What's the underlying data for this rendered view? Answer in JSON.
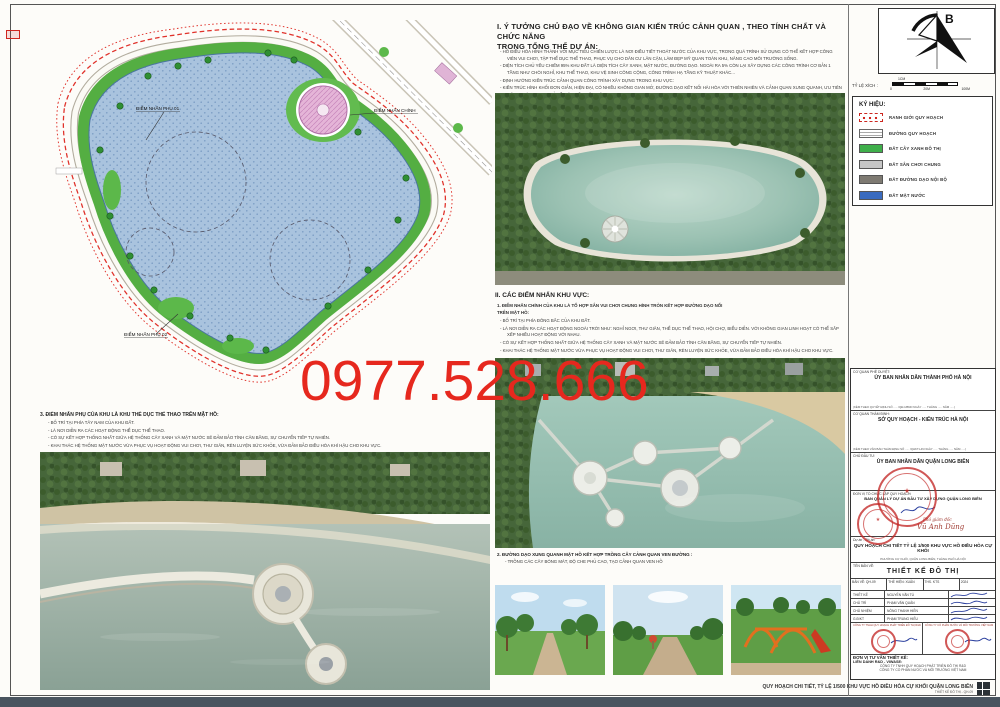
{
  "watermark": {
    "text": "0977.528.666",
    "color": "#e6281e"
  },
  "section1": {
    "heading_line1": "I. Ý TƯỞNG CHỦ ĐẠO VỀ KHÔNG GIAN KIẾN TRÚC CẢNH QUAN , THEO TÍNH CHẤT  VÀ CHỨC NĂNG",
    "heading_line2": "TRONG TỔNG THỂ DỰ ÁN:",
    "bullets": [
      "HỒ ĐIỀU HÒA HÌNH THÀNH VỚI MỤC TIÊU CHIẾN LƯỢC LÀ NƠI ĐIỀU TIẾT THOÁT NƯỚC CỦA KHU VỰC, TRONG QUÁ TRÌNH SỬ DỤNG CÓ THỂ KẾT HỢP CÔNG VIÊN VUI CHƠI, TẬP THỂ DỤC THỂ THAO, PHỤC VỤ CHO DÂN CƯ LÂN CẬN, LÀM ĐẸP MỸ QUAN TOÀN KHU, NÂNG CAO MÔI TRƯỜNG SỐNG.",
      "DIỆN TÍCH CHỦ YẾU CHIẾM 95% KHU ĐẤT LÀ DIỆN TÍCH CÂY XANH, MẶT NƯỚC, ĐƯỜNG DẠO. NGOÀI RA 5% CÒN LẠI XÂY DỰNG CÁC CÔNG TRÌNH CƠ BẢN 1 TẦNG NHƯ CHÒI NGHỈ, KHU THỂ THAO, KHU VỆ SINH CÔNG CỘNG, CÔNG TRÌNH HẠ TẦNG KỸ THUẬT KHÁC...",
      "ĐỊNH HƯỚNG KIẾN TRÚC CẢNH QUAN CÔNG TRÌNH XÂY DỰNG TRONG KHU VỰC:",
      "KIẾN TRÚC HÌNH KHỐI ĐƠN GIẢN, HIỆN ĐẠI, CÓ NHIỀU KHÔNG GIAN MỞ, ĐƯỜNG DẠO KẾT NỐI HÀI HÒA VỚI THIÊN NHIÊN VÀ CẢNH QUAN XUNG QUANH, ƯU TIÊN CÔNG TRÌNH XANH, VỎ BỀ MẶT TIẾT KIỆM NĂNG LƯỢNG.",
      "KIẾN TRÚC CÔNG TRÌNH SỬ DỤNG MÁI DỐC, KẾT HỢP MÁI BẰNG TẠO CÁC ĐƯỜNG NÉT HÀI HÒA, MỀM MẠI. SỬ DỤNG CÁC TÔNG MÀU SÁNG, TRANG NHÃ. KHAI THÁC HÌNH TƯỢNG VĂN HÓA, LỊCH SỬ TẠO NÉT ĐẶC TRƯNG, NỔI BẬT THỂ HIỆN RÕ TÍNH CHẤT CHỦ ĐẠO TRONG TỔNG THỂ.",
      "BỐ TRÍ NHIỀU CÁC MẢNG XANH, KHÔNG GIAN XANH, KHÔNG GIAN MỞ."
    ]
  },
  "section2": {
    "heading": "II. CÁC ĐIỂM NHẤN KHU VỰC:",
    "intro_line1": "1. ĐIỂM NHẤN CHÍNH CỦA KHU LÀ TỔ HỢP SÂN VUI CHƠI CHUNG HÌNH TRÒN KẾT HỢP ĐƯỜNG DẠO NỔI",
    "intro_line2": "TRÊN MẶT HỒ:",
    "bullets": [
      "BỐ TRÍ TẠI PHÍA ĐÔNG BẮC CỦA KHU ĐẤT.",
      "LÀ NƠI DIỄN RA CÁC HOẠT ĐỘNG NGOÀI TRỜI NHƯ: NGHỈ NGƠI, THƯ GIÃN, THỂ DỤC THỂ THAO, HỘI CHỢ, BIỂU DIỄN. VỚI KHÔNG GIAN LINH HOẠT CÓ THỂ SẮP XẾP NHIỀU HOẠT ĐỘNG VỚI NHAU.",
      "CÓ SỰ KẾT HỢP THỐNG NHẤT GIỮA HỆ THỐNG CÂY XANH VÀ MẶT NƯỚC SẼ ĐẢM BẢO TÍNH CÂN BẰNG, SỰ CHUYỂN TIẾP TỰ NHIÊN.",
      "KHAI THÁC HỆ THỐNG MẶT NƯỚC VỪA PHỤC VỤ HOẠT ĐỘNG VUI CHƠI, THƯ GIÃN, RÈN LUYỆN SỨC KHỎE, VỪA ĐẢM BẢO ĐIỀU HÒA KHÍ HẬU CHO KHU VỰC."
    ]
  },
  "section3_left": {
    "heading": "3. ĐIỂM NHẤN PHỤ CỦA KHU LÀ KHU THỂ DỤC THỂ THAO TRÊN MẶT HỒ:",
    "bullets": [
      "BỐ TRÍ TẠI PHÍA TÂY NAM CỦA KHU ĐẤT.",
      "LÀ NƠI DIỄN RA CÁC HOẠT ĐỘNG THỂ DỤC THỂ THAO.",
      "CÓ SỰ KẾT HỢP THỐNG NHẤT GIỮA HỆ THỐNG CÂY XANH VÀ MẶT NƯỚC SẼ ĐẢM BẢO TÍNH CÂN BẰNG, SỰ CHUYỂN TIẾP TỰ NHIÊN.",
      "KHAI THÁC HỆ THỐNG MẶT NƯỚC VỪA PHỤC VỤ HOẠT ĐỘNG VUI CHƠI, THƯ GIÃN, RÈN LUYỆN SỨC KHỎE, VỪA ĐẢM BẢO ĐIỀU HÒA KHÍ HẬU CHO KHU VỰC."
    ]
  },
  "section_photos": {
    "heading": "2. ĐƯỜNG DẠO XUNG QUANH MẶT HỒ KẾT HỢP TRỒNG CÂY CẢNH QUAN VEN ĐƯỜNG :",
    "bullet": "TRỒNG CÁC CÂY BÓNG MÁT, ĐỘ CHE PHỦ CAO, TẠO CẢNH QUAN VEN HỒ"
  },
  "map": {
    "label_main": "ĐIỂM NHẤN CHÍNH",
    "label_sub1": "ĐIỂM NHẤN PHỤ 01",
    "label_sub2": "ĐIỂM NHẤN PHỤ 02"
  },
  "compass": {
    "north_label": "B"
  },
  "scale": {
    "caption": "TỶ LỆ XÍCH :",
    "cm": "1CM",
    "t0": "0",
    "t20": "20M",
    "t100": "100M"
  },
  "legend": {
    "title": "KÝ HIỆU:",
    "items": [
      {
        "label": "RANH GIỚI QUY HOẠCH",
        "type": "boundary"
      },
      {
        "label": "ĐƯỜNG QUY HOẠCH",
        "type": "road"
      },
      {
        "label": "ĐẤT CÂY XANH ĐÔ THỊ",
        "color": "#3faf4b"
      },
      {
        "label": "ĐẤT SÂN CHƠI CHUNG",
        "color": "#c6c6c6"
      },
      {
        "label": "ĐẤT ĐƯỜNG DẠO NỘI BỘ",
        "color": "#7e7a72"
      },
      {
        "label": "ĐẤT MẶT NƯỚC",
        "color": "#3a6bbf"
      }
    ]
  },
  "titleblock": {
    "approve_label": "CƠ QUAN PHÊ DUYỆT:",
    "approve_org": "ỦY BAN NHÂN DÂN THÀNH PHỐ HÀ NỘI",
    "approve_note": "(KÈM THEO QUYẾT ĐỊNH SỐ ..... /QĐ-UBND NGÀY ..... THÁNG ..... NĂM .....)",
    "appraise_label": "CƠ QUAN THẨM ĐỊNH:",
    "appraise_org": "SỞ QUY HOẠCH - KIẾN TRÚC HÀ NỘI",
    "appraise_note": "(KÈM THEO VĂN BẢN THẨM ĐỊNH SỐ ..... /QHKT-HN NGÀY ..... THÁNG ..... NĂM .....)",
    "investor_label": "CHỦ ĐẦU TƯ:",
    "investor_org": "ỦY BAN NHÂN DÂN QUẬN LONG BIÊN",
    "org_label": "ĐƠN VỊ TỔ CHỨC LẬP QUY HOẠCH:",
    "org_name": "BAN QUẢN LÝ DỰ ÁN ĐẦU TƯ XÂY DỰNG QUẬN LONG BIÊN",
    "deputy_title": "Phó giám đốc",
    "deputy_sign": "Vũ Anh Dũng",
    "project_label": "Dự án - Đồ án:",
    "project_name": "QUY HOẠCH CHI TIẾT TỶ LỆ 1/500 KHU VỰC HỒ ĐIỀU HÒA CỰ KHỐI",
    "project_loc": "PHƯỜNG CỰ KHỐI, QUẬN LONG BIÊN, THÀNH PHỐ HÀ NỘI",
    "sheetname_label": "TÊN BẢN VẼ:",
    "sheet_name": "THIẾT KẾ ĐÔ THỊ",
    "meta": [
      "BẢN VẼ: QH-09",
      "THỂ HIỆN: XUÂN",
      "THS. KTS",
      "2024"
    ],
    "staff": [
      {
        "role": "THIẾT KẾ",
        "name": "NGUYỄN VĂN TÚ"
      },
      {
        "role": "CHỦ TRÌ",
        "name": "PHẠM VĂN QUÂN"
      },
      {
        "role": "CHỦ NHIỆM",
        "name": "NÔNG THANH HIỀN"
      },
      {
        "role": "G.Đ/KT",
        "name": "PHẠM TRUNG HIẾU"
      }
    ],
    "consult_label": "ĐƠN VỊ TƯ VẤN THIẾT KẾ:",
    "consult_liendanh": "LIÊN DANH R&D - VIWASE:",
    "consult_co1": "CÔNG TY TNHH QUY HOẠCH PHÁT TRIỂN ĐÔ THỊ R&D",
    "consult_co2": "CÔNG TY CỔ PHẦN NƯỚC VÀ MÔI TRƯỜNG VIỆT NAM"
  },
  "footer": {
    "line1": "QUY HOẠCH CHI TIẾT, TỶ LỆ 1/500 KHU VỰC HỒ ĐIỀU HÒA CỰ KHỐI QUẬN LONG BIÊN",
    "line2": "THIẾT KẾ ĐÔ THỊ - QH-09"
  }
}
